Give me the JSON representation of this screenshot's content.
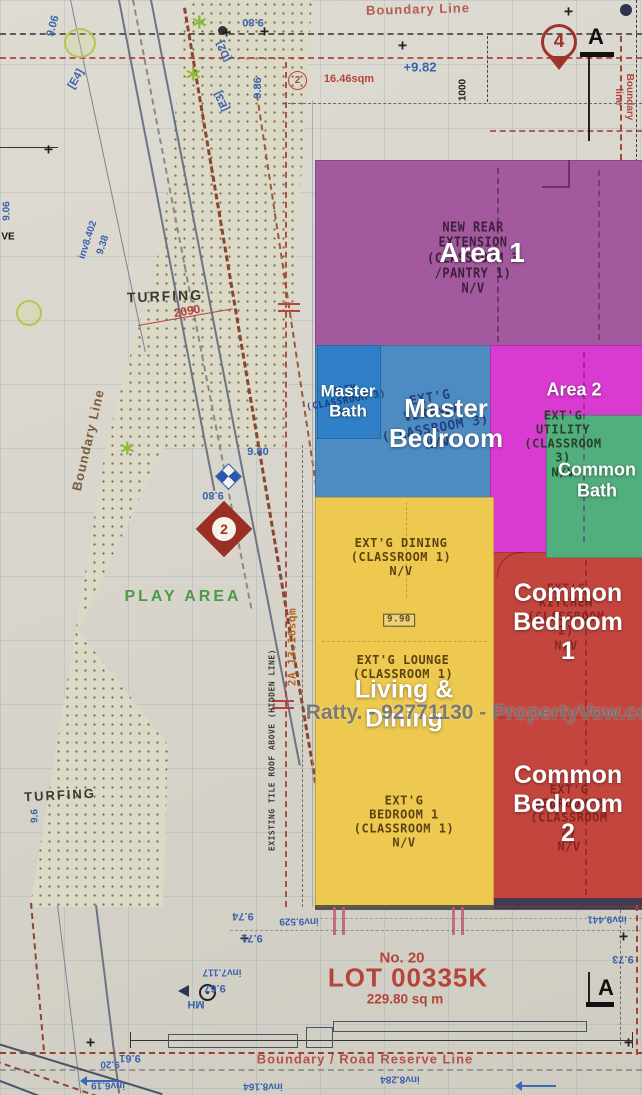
{
  "watermark": "Ratty. - 92771130 - PropertyVow.com",
  "lot": {
    "no": "No. 20",
    "id": "LOT 00335K",
    "area": "229.80 sq m"
  },
  "regions": [
    {
      "id": "area-1",
      "label": "Area 1",
      "color": "#a2599d",
      "plan_text": "NEW REAR\nEXTENSION\n(CLASSROOM 3\n/PANTRY 1)\nN/V"
    },
    {
      "id": "master-bath",
      "label": "Master\nBath",
      "color": "#2f80c6",
      "plan_text": "BATH\n(CLASSROOM 3)\nN/V"
    },
    {
      "id": "master-bedroom",
      "label": "Master\nBedroom",
      "color": "#4d8cc2",
      "plan_text": "EXT'G\nVERANDA\n(CLASSROOM 3)\nN/V"
    },
    {
      "id": "area-2",
      "label": "Area 2",
      "color": "#d93ad0",
      "plan_text": "EXT'G UTILITY\n(CLASSROOM 3)\nN/V"
    },
    {
      "id": "common-bath",
      "label": "Common\nBath",
      "color": "#50af7d",
      "plan_text": ""
    },
    {
      "id": "common-bedroom-1",
      "label": "Common\nBedroom 1",
      "color": "#c4453e",
      "plan_text": "EXT'G KITCHEN\n(CLASSROOM 2)\nN/V"
    },
    {
      "id": "living-dining",
      "label": "Living &\nDining",
      "color": "#eec94f",
      "plan_text": "EXT'G DINING\n(CLASSROOM 1)\nN/V"
    },
    {
      "id": "common-bedroom-2",
      "label": "Common\nBedroom 2",
      "color": "#c4453e",
      "plan_text": "EXT'G\nBEDROOM 2\n(CLASSROOM 2)\nN/V"
    }
  ],
  "plans": {
    "lounge": "EXT'G LOUNGE\n(CLASSROOM 1)",
    "bedroom1": "EXT'G\nBEDROOM 1\n(CLASSROOM 1)\nN/V",
    "level_badge": "9.90"
  },
  "site": {
    "boundary_top": "Boundary Line",
    "boundary_left": "Boundary Line",
    "boundary_right": "Boundary line",
    "road_reserve": "Boundary  /  Road Reserve Line",
    "turfing_upper": "TURFING",
    "turfing_lower": "TURFING",
    "play_area": "PLAY AREA",
    "roof_note": "EXISTING TILE ROOF ABOVE (HIDDEN LINE)",
    "area_2a": "2A  13.16sqm",
    "area_2_sqm": "16.46sqm",
    "dim_2090": "2090",
    "dim_1000": "1000",
    "marker_2_top": "2",
    "marker_2_diamond": "2",
    "marker_4": "4",
    "marker_a_top": "A",
    "marker_a_bottom": "A",
    "mh": "MH"
  },
  "levels": {
    "l982": "+9.82",
    "l980_top": "9.80",
    "l986": "9.86",
    "l906_a": "9.06",
    "l906_b": "9.06",
    "l938": "9.38",
    "inv8402": "inv8.402",
    "d2": "[D2]",
    "e3": "[E3]",
    "e4": "[E4]",
    "ve": "VE",
    "l980_mid": "9.80",
    "l980_diamond": "9.80",
    "l96": "9.6",
    "l967": "9.67",
    "inv7117": "inv7.117",
    "l971": "9.71",
    "l974": "9.74",
    "inv9529": "inv9.529",
    "inv9441": "inv9.441",
    "l973": "9.73",
    "l961": "9.61",
    "l920": "9.20",
    "inv619": "inv6.19",
    "inv8164": "inv8.164",
    "inv8284": "inv8.284"
  }
}
